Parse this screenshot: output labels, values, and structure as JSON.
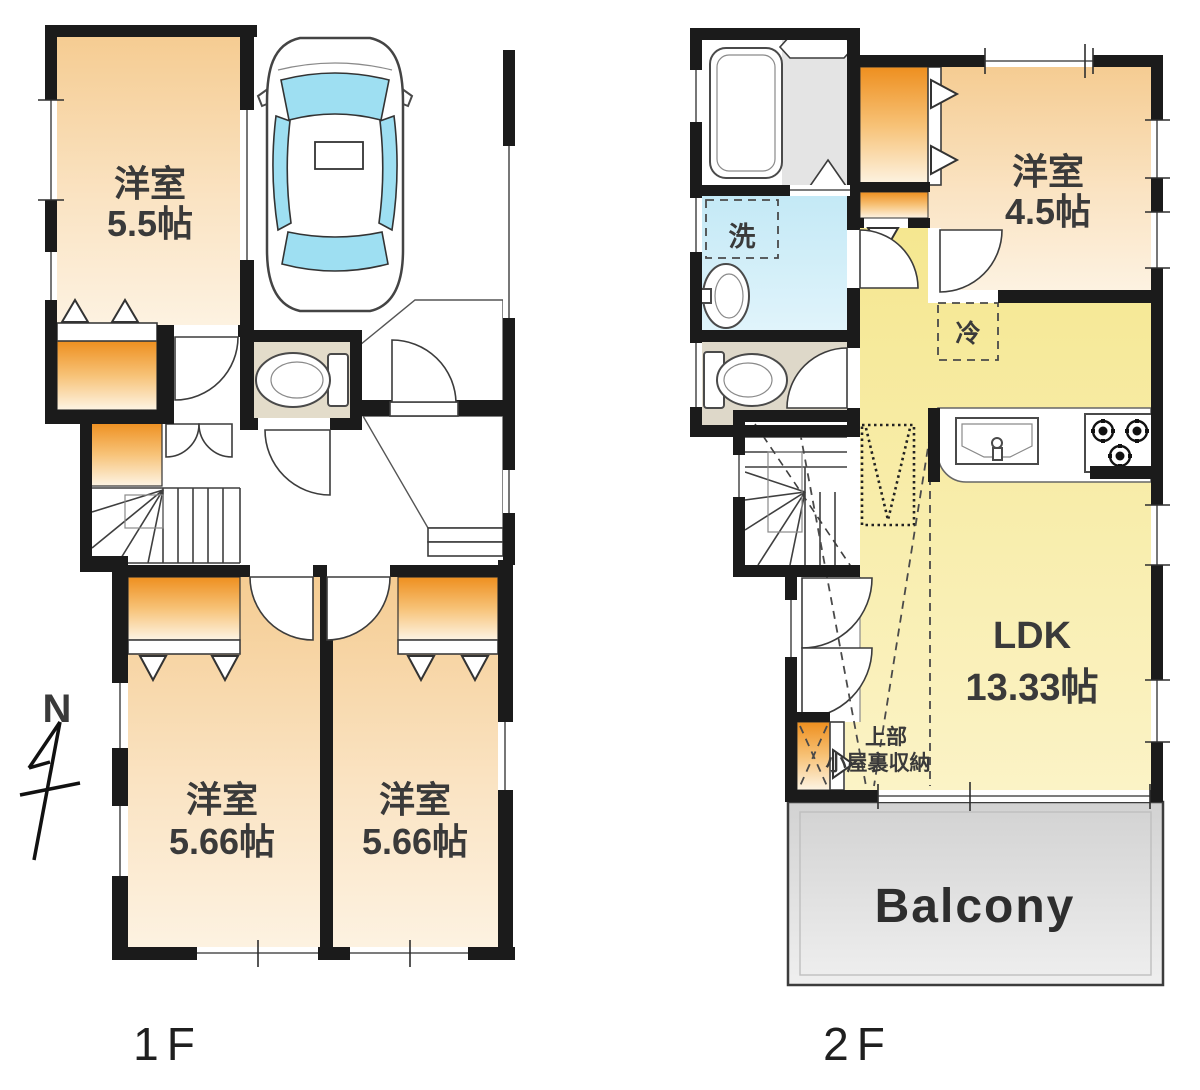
{
  "labels": {
    "floor1": "1F",
    "floor2": "2F",
    "north": "N",
    "balcony": "Balcony",
    "washer": "洗",
    "fridge": "冷",
    "attic_line1": "上部",
    "attic_line2": "小屋裏収納"
  },
  "rooms": {
    "f1_bedroom_a": {
      "name": "洋室",
      "size": "5.5帖"
    },
    "f1_bedroom_b": {
      "name": "洋室",
      "size": "5.66帖"
    },
    "f1_bedroom_c": {
      "name": "洋室",
      "size": "5.66帖"
    },
    "f2_bedroom": {
      "name": "洋室",
      "size": "4.5帖"
    },
    "f2_ldk": {
      "name": "LDK",
      "size": "13.33帖"
    }
  },
  "colors": {
    "wall": "#1b1b1b",
    "room_peach_top": "#f5cc92",
    "room_peach_bottom": "#fdf2e1",
    "closet_orange_top": "#ee8f1f",
    "closet_orange_bottom": "#fdf4e4",
    "ldk_yellow_top": "#f6e996",
    "ldk_yellow_bottom": "#faf2c4",
    "washroom_blue": "#cdecf7",
    "toilet_beige": "#e3dcca",
    "balcony_gray": "#d9d9d9",
    "car_glass_blue": "#9edff2",
    "porch_tile_gray": "#9f9f9f",
    "genkan_tile_gray": "#c7c7c7"
  }
}
